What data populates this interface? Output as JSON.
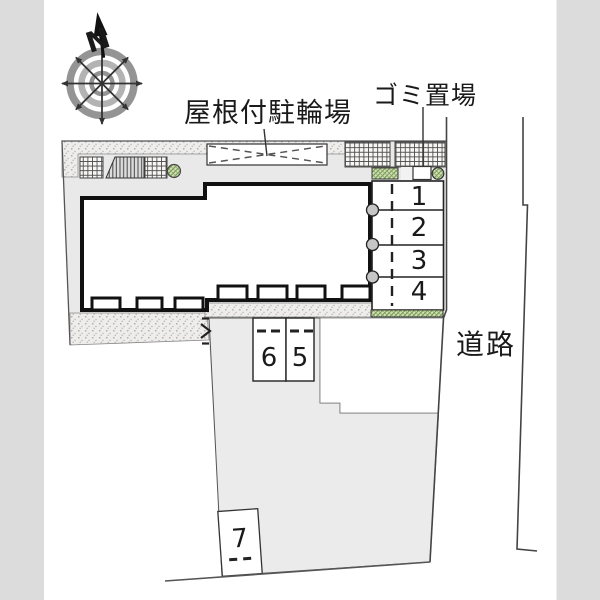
{
  "labels": {
    "bicycle_parking": "屋根付駐輪場",
    "garbage": "ゴミ置場",
    "road": "道路",
    "north": "N"
  },
  "spaces": [
    "1",
    "2",
    "3",
    "4",
    "5",
    "6",
    "7"
  ],
  "colors": {
    "page_margin_gray": "#dcdcdc",
    "site_gray": "#e9e9e9",
    "parking_gray": "#ebebeb",
    "building_outline": "#111111",
    "planting_green": "#cfe2ae",
    "line_dark": "#444444",
    "text": "#1a1a1a"
  }
}
